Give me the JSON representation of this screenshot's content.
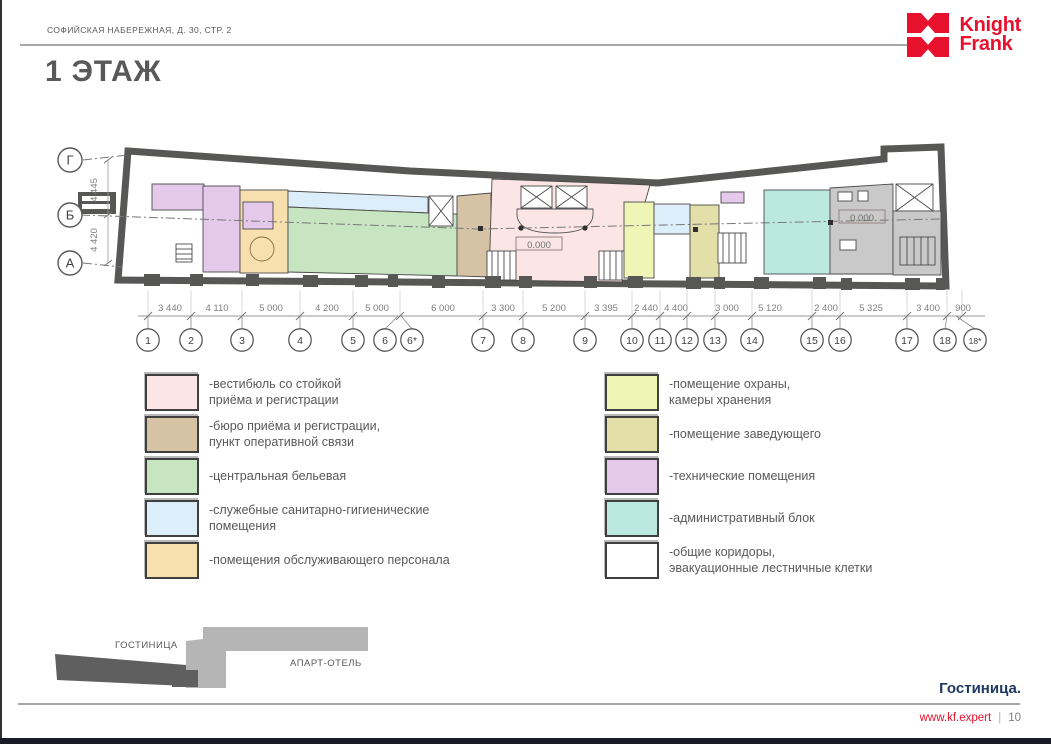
{
  "header": {
    "address": "СОФИЙСКАЯ НАБЕРЕЖНАЯ, Д. 30, СТР. 2"
  },
  "logo": {
    "name": "Knight Frank",
    "line1": "Knight",
    "line2": "Frank",
    "color": "#e8112d"
  },
  "page_title": "1 ЭТАЖ",
  "plan": {
    "row_axes": [
      {
        "label": "Г",
        "y": 160
      },
      {
        "label": "Б",
        "y": 215
      },
      {
        "label": "А",
        "y": 263
      }
    ],
    "row_dims": [
      {
        "text": "4 445",
        "y": 190
      },
      {
        "text": "4 420",
        "y": 240
      }
    ],
    "level_marks": [
      {
        "text": "0.000",
        "x": 539,
        "y": 247
      },
      {
        "text": "0.000",
        "x": 862,
        "y": 220
      }
    ],
    "columns": [
      {
        "label": "1",
        "x": 148
      },
      {
        "label": "2",
        "x": 191
      },
      {
        "label": "3",
        "x": 242
      },
      {
        "label": "4",
        "x": 300
      },
      {
        "label": "5",
        "x": 353
      },
      {
        "label": "6",
        "x": 385,
        "tx": 398
      },
      {
        "label": "6*",
        "x": 412,
        "tx": 401
      },
      {
        "label": "7",
        "x": 483
      },
      {
        "label": "8",
        "x": 523
      },
      {
        "label": "9",
        "x": 585
      },
      {
        "label": "10",
        "x": 632
      },
      {
        "label": "11",
        "x": 660
      },
      {
        "label": "12",
        "x": 687
      },
      {
        "label": "13",
        "x": 715
      },
      {
        "label": "14",
        "x": 752
      },
      {
        "label": "15",
        "x": 812
      },
      {
        "label": "16",
        "x": 840
      },
      {
        "label": "17",
        "x": 907
      },
      {
        "label": "18",
        "x": 945,
        "tx": 947
      },
      {
        "label": "18*",
        "x": 975,
        "tx": 956
      }
    ],
    "ticks": [
      148,
      191,
      242,
      300,
      353,
      400,
      483,
      523,
      585,
      632,
      660,
      687,
      715,
      752,
      812,
      840,
      907,
      947,
      962
    ],
    "dims": [
      {
        "text": "3 440",
        "x": 170
      },
      {
        "text": "4 110",
        "x": 217
      },
      {
        "text": "5 000",
        "x": 271
      },
      {
        "text": "4 200",
        "x": 327
      },
      {
        "text": "5 000",
        "x": 377
      },
      {
        "text": "6 000",
        "x": 443
      },
      {
        "text": "3 300",
        "x": 503
      },
      {
        "text": "5 200",
        "x": 554
      },
      {
        "text": "3 395",
        "x": 606
      },
      {
        "text": "2 440",
        "x": 646
      },
      {
        "text": "4 400",
        "x": 676
      },
      {
        "text": "3 000",
        "x": 727
      },
      {
        "text": "5 120",
        "x": 770
      },
      {
        "text": "2 400",
        "x": 826
      },
      {
        "text": "5 325",
        "x": 871
      },
      {
        "text": "3 400",
        "x": 928
      },
      {
        "text": "900",
        "x": 963
      }
    ]
  },
  "legend": {
    "left": [
      {
        "color": "#fbe5e5",
        "label": "-вестибюль со стойкой\nприёма и регистрации"
      },
      {
        "color": "#d6c3a5",
        "label": "-бюро приёма и регистрации,\nпункт оперативной связи"
      },
      {
        "color": "#c8e5c1",
        "label": "-центральная бельевая"
      },
      {
        "color": "#dceef9",
        "label": "-служебные санитарно-гигиенические\nпомещения"
      },
      {
        "color": "#f7dfae",
        "label": "-помещения обслуживающего персонала"
      }
    ],
    "right": [
      {
        "color": "#eef5b5",
        "label": "-помещение охраны,\nкамеры хранения"
      },
      {
        "color": "#e3dfa9",
        "label": "-помещение заведующего"
      },
      {
        "color": "#e4c9ea",
        "label": "-технические помещения"
      },
      {
        "color": "#bce9df",
        "label": "-административный блок"
      },
      {
        "color": "#ffffff",
        "label": "-общие коридоры,\nэвакуационные лестничные клетки"
      }
    ]
  },
  "minimap": {
    "hotel_label": "ГОСТИНИЦА",
    "apart_label": "АПАРТ-ОТЕЛЬ"
  },
  "footer": {
    "section_label": "Гостиница.",
    "site": "www.kf.expert",
    "divider": "|",
    "page": "10"
  }
}
